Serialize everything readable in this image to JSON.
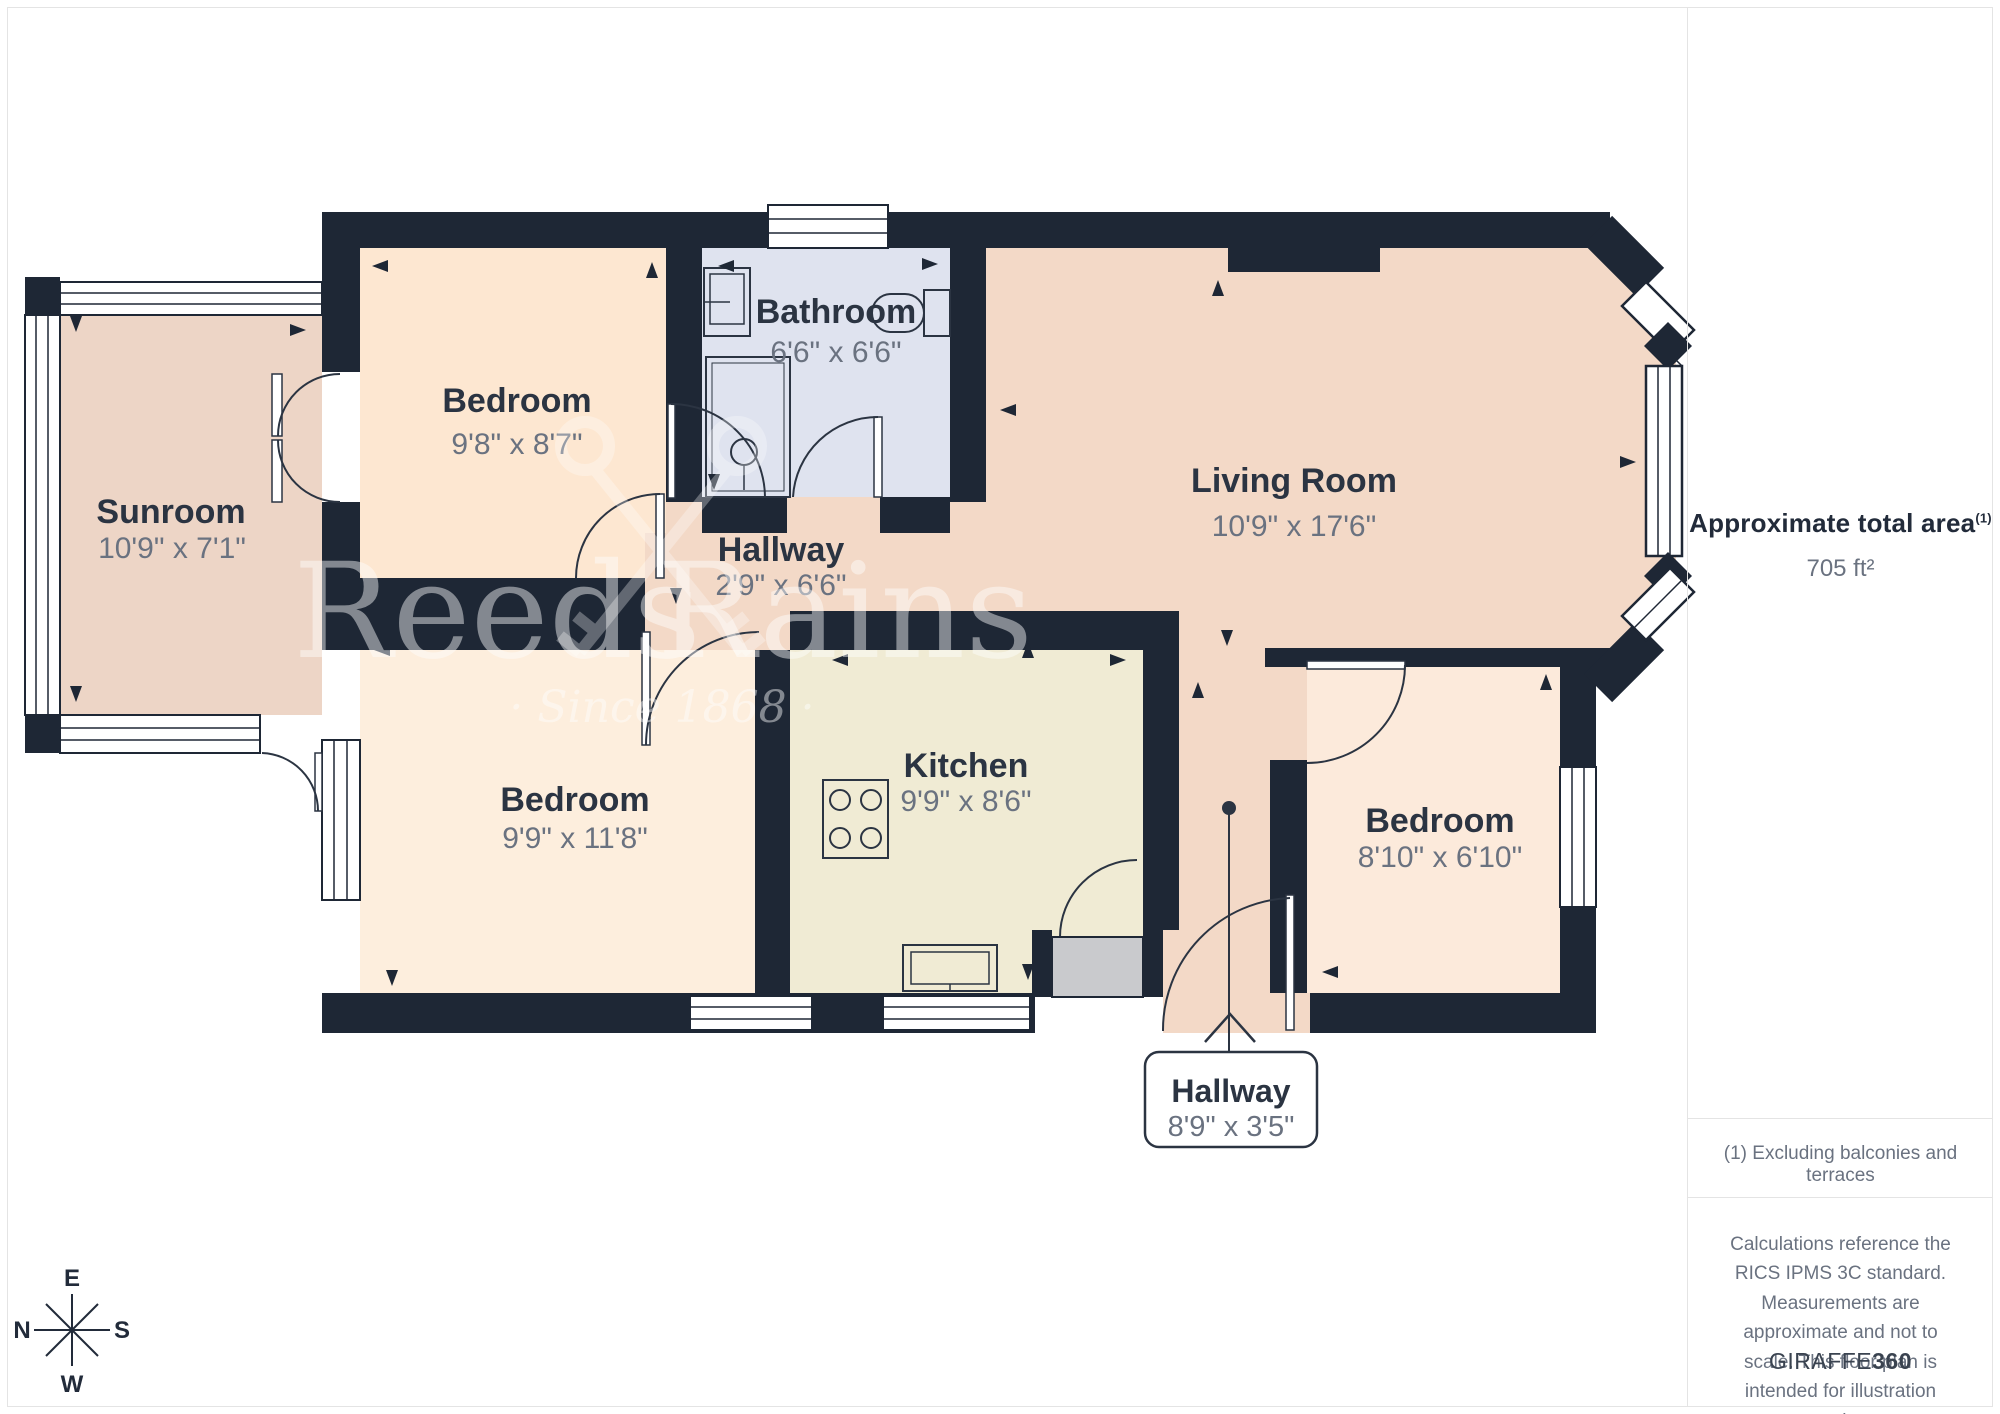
{
  "palette": {
    "wall": "#1e2735",
    "room_name_text": "#2b3442",
    "room_dims_text": "#6a7280",
    "sunroom_floor": "#edd5c6",
    "living_floor": "#f3d9c7",
    "bed_tl_floor": "#fde7d1",
    "bed_bl_floor": "#fdeedd",
    "bed_br_floor": "#fceadb",
    "bath_floor": "#dfe3ef",
    "kitchen_floor": "#f0ebd4",
    "porch_step": "#c9cacd",
    "frame_border": "#e4e4e4"
  },
  "rooms": [
    {
      "id": "sunroom",
      "name": "Sunroom",
      "dims": "10'9\" x 7'1\""
    },
    {
      "id": "bedroom-tl",
      "name": "Bedroom",
      "dims": "9'8\" x 8'7\""
    },
    {
      "id": "bathroom",
      "name": "Bathroom",
      "dims": "6'6\" x 6'6\""
    },
    {
      "id": "hallway-center",
      "name": "Hallway",
      "dims": "2'9\" x 6'6\""
    },
    {
      "id": "living-room",
      "name": "Living Room",
      "dims": "10'9\" x 17'6\""
    },
    {
      "id": "bedroom-bl",
      "name": "Bedroom",
      "dims": "9'9\" x 11'8\""
    },
    {
      "id": "kitchen",
      "name": "Kitchen",
      "dims": "9'9\" x 8'6\""
    },
    {
      "id": "bedroom-br",
      "name": "Bedroom",
      "dims": "8'10\" x 6'10\""
    },
    {
      "id": "hallway-bottom",
      "name": "Hallway",
      "dims": "8'9\" x 3'5\""
    }
  ],
  "watermark": {
    "word1": "Reeds",
    "word2": "Rains",
    "tagline": "· Since 1868 ·"
  },
  "sidebar": {
    "area_label": "Approximate total area",
    "area_footnote_mark": "(1)",
    "area_value": "705 ft²",
    "footnote": "(1) Excluding balconies and terraces",
    "disclaimer": "Calculations reference the RICS IPMS 3C standard. Measurements are approximate and not to scale. This floor plan is intended for illustration only.",
    "brand_regular": "GIRAFFE",
    "brand_bold": "360"
  },
  "compass": {
    "north": "N",
    "east": "E",
    "south": "S",
    "west": "W"
  }
}
